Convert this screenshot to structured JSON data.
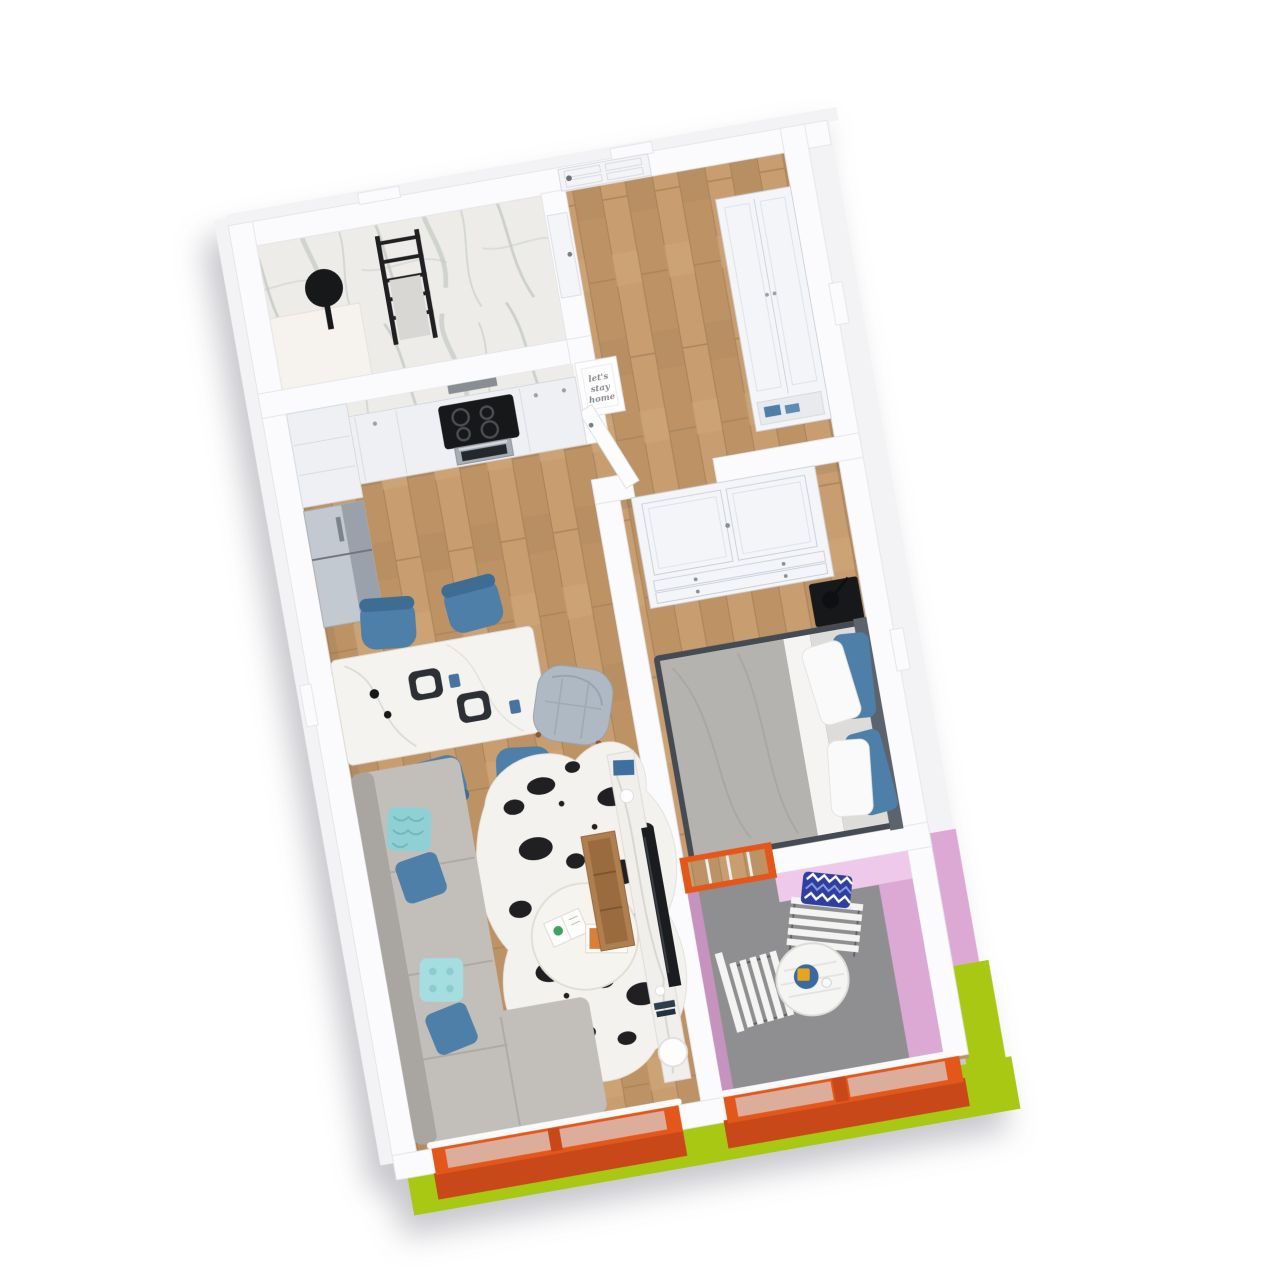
{
  "scene": {
    "type": "3d-floorplan-render",
    "description": "Isometric 3D rendering of a one-bedroom apartment floor plan, rotated slightly counter-clockwise on a white background with a soft shadow",
    "rotation_deg": -10
  },
  "wall_art": {
    "line1": "let's",
    "line2": "stay",
    "line3": "home"
  },
  "colors": {
    "orange": "#E4571B",
    "orange_dark": "#C8481A",
    "green": "#A8C814",
    "pink_light": "#EFC9E9",
    "pink": "#DCA9D4",
    "pink_dark": "#C693BE",
    "chair_blue": "#4D7FA8",
    "navy": "#2E3F9F",
    "teal": "#8FD0D4",
    "balcony_gray": "#8F8F92",
    "sofa_gray": "#C2BFBA",
    "duvet_gray": "#B5B3AF",
    "wood": "#C49A6C",
    "black": "#17181A",
    "marble": "#EDECE9",
    "wall_white": "#FBFBFD"
  },
  "apartment": {
    "rooms": [
      {
        "id": "bathroom",
        "features": [
          "marble clad walls",
          "round black mirror",
          "black towel ladder with towel",
          "white vanity block"
        ]
      },
      {
        "id": "entry-hall",
        "features": [
          "white paneled front door",
          "white hallway wardrobe with blue shoes",
          "wood flooring"
        ]
      },
      {
        "id": "kitchen",
        "features": [
          "white cabinets",
          "marble backsplash",
          "black cooktop with 4 burners",
          "stainless oven",
          "gray refrigerator"
        ]
      },
      {
        "id": "dining-area",
        "features": [
          "white stone dining table",
          "4 blue chairs",
          "dark square plates",
          "blue glasses",
          "black candlesticks"
        ]
      },
      {
        "id": "living-room",
        "features": [
          "gray corner sofa",
          "teal and blue cushions",
          "black and white cowhide rug",
          "round white coffee table with magazines",
          "marble media console with TV",
          "wooden bench",
          "white ball lamp",
          "gray tufted armchair",
          "orange framed window"
        ]
      },
      {
        "id": "bedroom",
        "features": [
          "double bed with gray duvet",
          "white and blue pillows",
          "dark slate headboard",
          "white two-door wardrobe with drawers",
          "black nightstand with black lamp",
          "open white door"
        ]
      },
      {
        "id": "balcony",
        "features": [
          "pink walls",
          "gray floor",
          "white slatted bistro table and folding chairs",
          "navy chevron pillow",
          "blue serving tray with yellow cup",
          "orange railing with glass",
          "orange framed balcony door"
        ]
      }
    ]
  }
}
